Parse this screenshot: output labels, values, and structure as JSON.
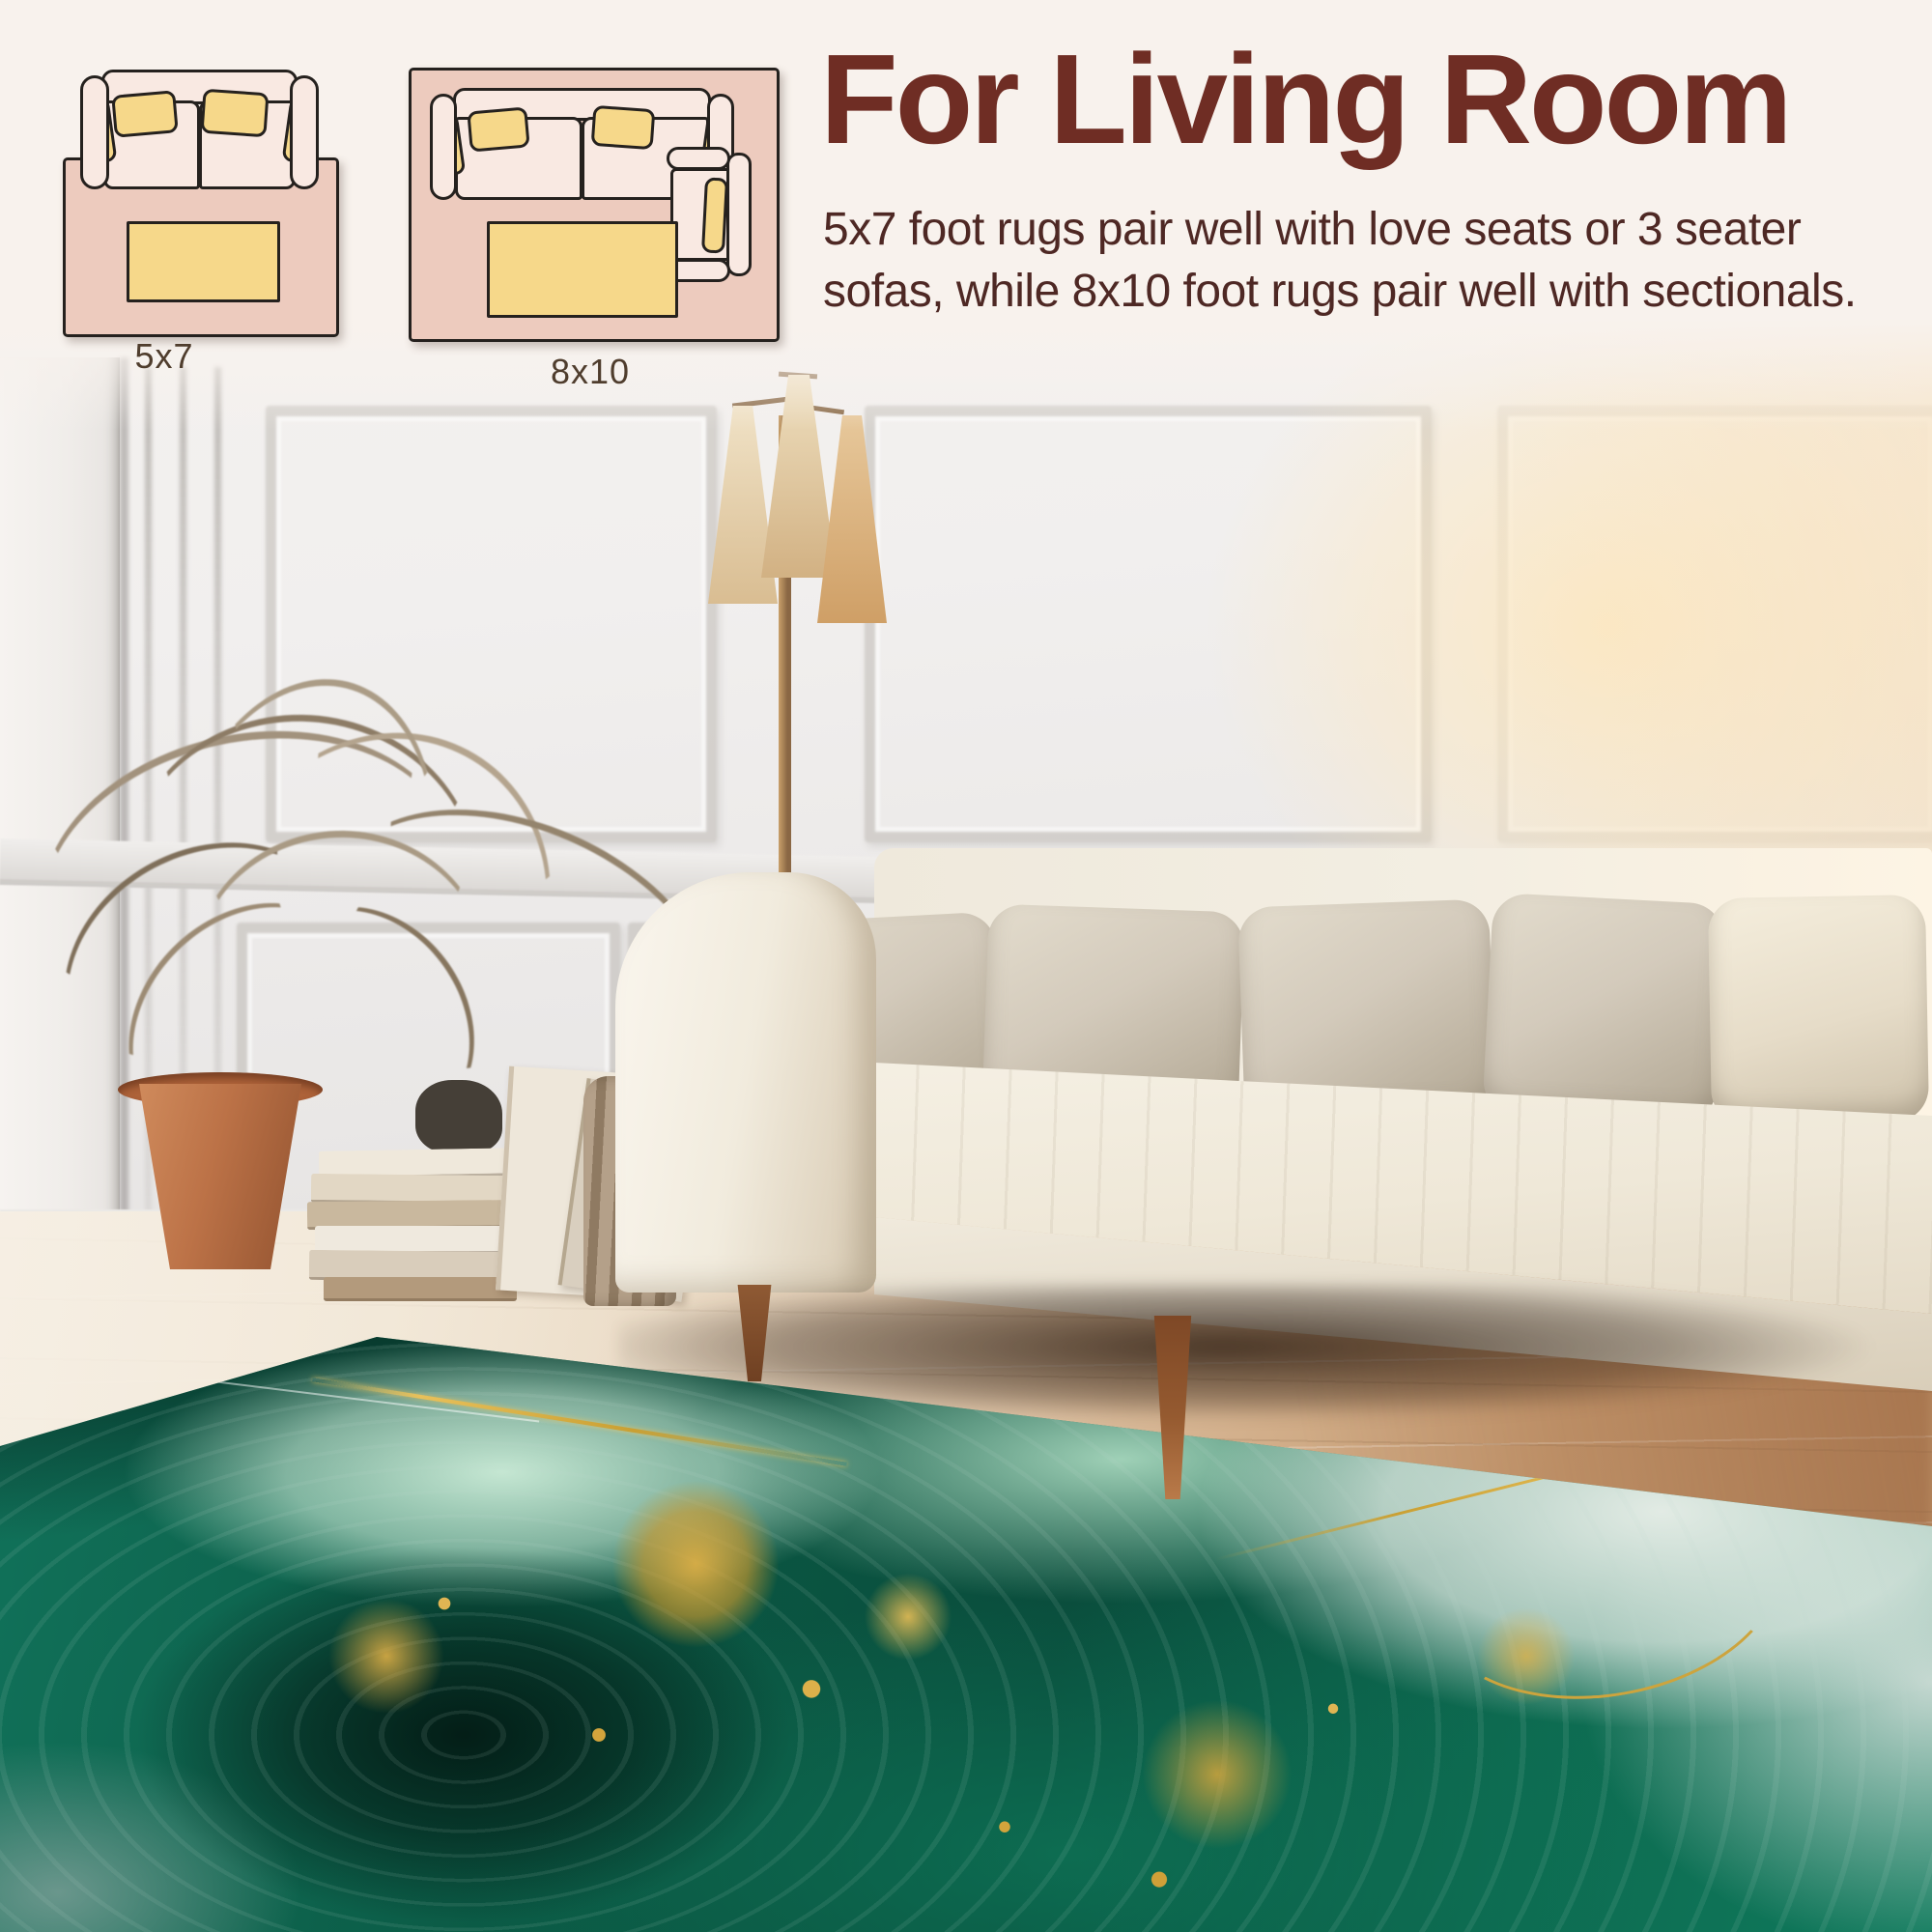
{
  "header": {
    "title": "For Living Room",
    "description_lines": [
      "5x7 foot rugs pair well with love seats or 3 seater",
      "sofas, while 8x10 foot rugs pair well with sectionals."
    ]
  },
  "size_diagrams": {
    "items": [
      {
        "label": "5x7",
        "illustration": "loveseat-on-rug-with-coffee-table"
      },
      {
        "label": "8x10",
        "illustration": "sofa-on-rug-with-coffee-table-and-armchair"
      }
    ]
  },
  "colors": {
    "band_bg": "#f8f2ed",
    "title_color": "#6f2d24",
    "body_color": "#4e2824",
    "label_color": "#4f3d2d",
    "outline": "#25211e",
    "diagram_rug": "#edcbbe",
    "diagram_sofa": "#f9e9e2",
    "diagram_cushion": "#f6d88a",
    "rug_emerald": "#0c6a50",
    "rug_dark": "#06352a",
    "rug_mint": "#c8ecd6",
    "rug_gold": "#d8a93e",
    "wall": "#f1efee",
    "sofa": "#f4efe5",
    "pillow": "#d5cdbe",
    "floor_light": "#ece2d2",
    "floor_warm": "#c49a74",
    "pot_terracotta": "#b97a52",
    "lamp_shade": "#e8d2ae"
  }
}
